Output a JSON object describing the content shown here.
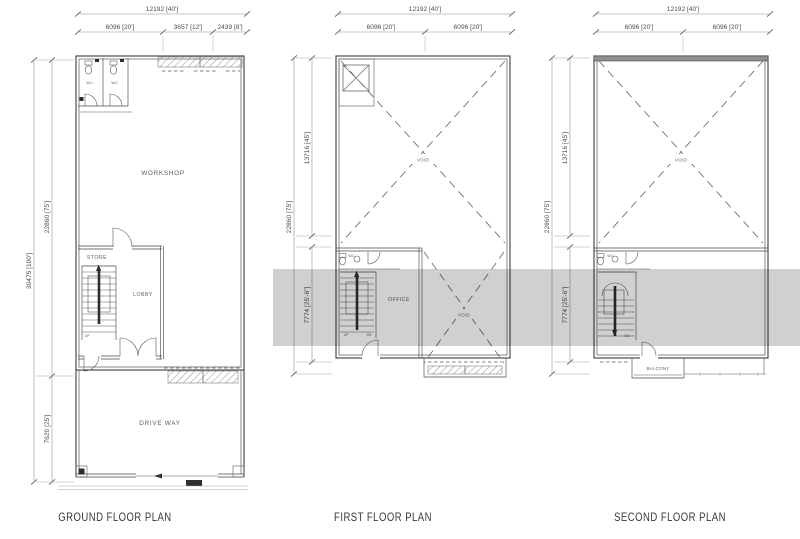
{
  "canvas": {
    "width": 800,
    "height": 539,
    "background": "#ffffff"
  },
  "colors": {
    "wall_line": "#3d3d3d",
    "dim_text": "#4d4d4d",
    "watermark_band": "#cbcbcb"
  },
  "plans": [
    {
      "id": "ground",
      "title": "GROUND FLOOR PLAN",
      "dims_top": {
        "overall": "12192 [40']",
        "segments": [
          "6096 [20']",
          "3657 [12']",
          "2439 [8']"
        ]
      },
      "dims_left": {
        "overall": "30475 [100']",
        "segments": [
          "22860 [75']",
          "7620 [25']"
        ]
      },
      "rooms": {
        "workshop": "WORKSHOP",
        "store": "STORE",
        "lobby": "LOBBY",
        "driveway": "DRIVE WAY"
      },
      "labels": {
        "up": "UP",
        "wc": "W.C."
      }
    },
    {
      "id": "first",
      "title": "FIRST FLOOR PLAN",
      "dims_top": {
        "overall": "12192 [40']",
        "segments": [
          "6096 [20']",
          "6096 [20']"
        ]
      },
      "dims_left": {
        "overall": "22860 [75']",
        "segments": [
          "13716 [45']",
          "7774 [25'-6\"]"
        ]
      },
      "rooms": {
        "void_upper": "VOID",
        "office": "OFFICE",
        "void_lower": "VOID"
      },
      "labels": {
        "up": "UP",
        "dn": "DN",
        "wc": "W.C."
      }
    },
    {
      "id": "second",
      "title": "SECOND FLOOR PLAN",
      "dims_top": {
        "overall": "12192 [40']",
        "segments": [
          "6096 [20']",
          "6096 [20']"
        ]
      },
      "dims_left": {
        "overall": "22860 [75']",
        "segments": [
          "13716 [45']",
          "7774 [25'-6\"]"
        ]
      },
      "rooms": {
        "void_upper": "VOID",
        "balcony": "BALCONY"
      },
      "labels": {
        "dn": "DN",
        "wc": "W.C."
      }
    }
  ]
}
